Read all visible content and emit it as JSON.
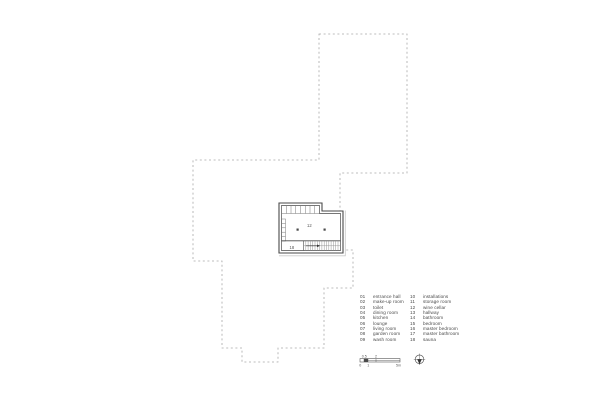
{
  "colors": {
    "dash_outline": "#a8a8a8",
    "wall": "#4a4a4a",
    "text": "#4a4a4a",
    "background": "#ffffff"
  },
  "plan": {
    "main_room_label": "12",
    "lower_room_label": "18"
  },
  "legend": {
    "left": [
      {
        "num": "01",
        "label": "entrance hall"
      },
      {
        "num": "02",
        "label": "make-up room"
      },
      {
        "num": "03",
        "label": "toilet"
      },
      {
        "num": "04",
        "label": "dining room"
      },
      {
        "num": "05",
        "label": "kitchen"
      },
      {
        "num": "06",
        "label": "lounge"
      },
      {
        "num": "07",
        "label": "living room"
      },
      {
        "num": "08",
        "label": "garden room"
      },
      {
        "num": "09",
        "label": "wash room"
      }
    ],
    "right": [
      {
        "num": "10",
        "label": "installations"
      },
      {
        "num": "11",
        "label": "storage room"
      },
      {
        "num": "12",
        "label": "wine cellar"
      },
      {
        "num": "13",
        "label": "hallway"
      },
      {
        "num": "14",
        "label": "bathroom"
      },
      {
        "num": "15",
        "label": "bedroom"
      },
      {
        "num": "16",
        "label": "master bedroom"
      },
      {
        "num": "17",
        "label": "master bathroom"
      },
      {
        "num": "18",
        "label": "sauna"
      }
    ]
  },
  "scale_bar": {
    "top": [
      "0.5",
      "2"
    ],
    "bottom": [
      "0",
      "1",
      "5m"
    ]
  },
  "icons": {
    "north_arrow": "compass-icon"
  }
}
